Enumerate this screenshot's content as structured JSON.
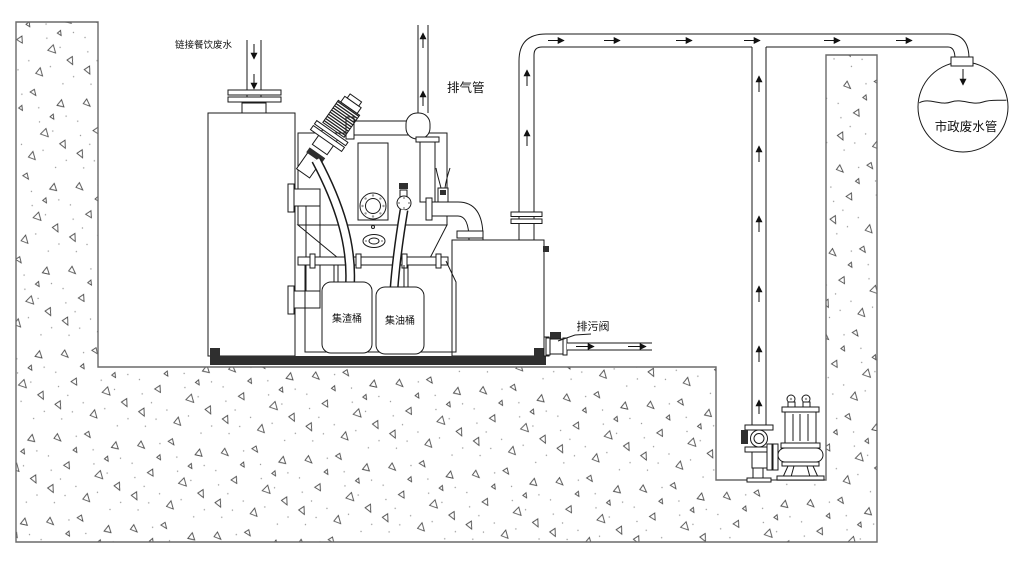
{
  "diagram": {
    "labels": {
      "inlet_pipe": "链接餐饮废水",
      "vent_pipe": "排气管",
      "slag_bucket": "集渣桶",
      "oil_bucket": "集油桶",
      "drain_valve": "排污阀",
      "municipal_sewer": "市政废水管"
    },
    "flow": {
      "inlet": "down",
      "vent": "up",
      "discharge_main": "right",
      "pump_riser": "up",
      "drain_outlet": "right",
      "municipal_drop": "down"
    },
    "colors": {
      "line": "#1a1a1a",
      "concrete_edge": "#6a6a6a",
      "base_plate": "#2f2f2f",
      "background": "#ffffff"
    }
  }
}
